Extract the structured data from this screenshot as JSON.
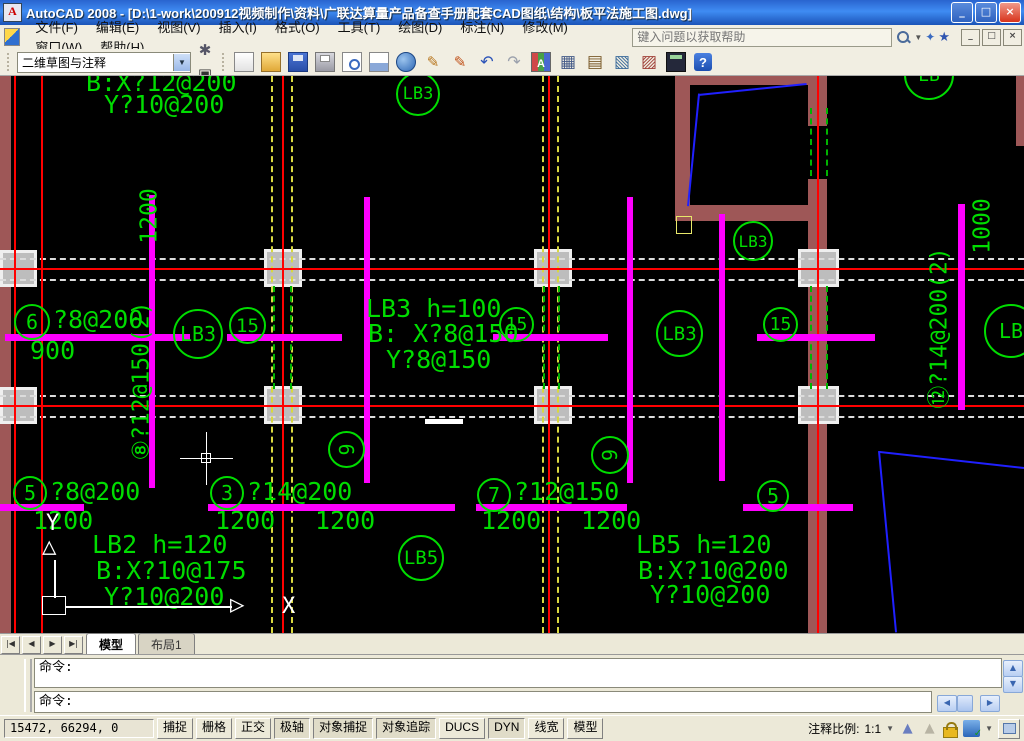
{
  "title_bar": {
    "title": "AutoCAD 2008 - [D:\\1-work\\200912视频制作\\资料\\广联达算量产品备查手册配套CAD图纸\\结构\\板平法施工图.dwg]",
    "buttons": {
      "minimize": "_",
      "restore": "□",
      "close": "×"
    }
  },
  "menu": {
    "items": [
      "文件(F)",
      "编辑(E)",
      "视图(V)",
      "插入(I)",
      "格式(O)",
      "工具(T)",
      "绘图(D)",
      "标注(N)",
      "修改(M)",
      "窗口(W)",
      "帮助(H)"
    ],
    "search_placeholder": "键入问题以获取帮助",
    "mdi_buttons": {
      "minimize": "_",
      "restore": "□",
      "close": "×"
    }
  },
  "toolbar": {
    "workspace": "二维草图与注释",
    "workspace_buttons": [
      "gear",
      "ws"
    ],
    "icons": [
      "new",
      "open",
      "save",
      "plot",
      "preview",
      "publish",
      "web",
      "pencil",
      "pencil2",
      "undo",
      "redo",
      "matchprop",
      "layers",
      "sheetset",
      "markup",
      "blockedit",
      "calc",
      "help"
    ]
  },
  "tabs": {
    "nav": [
      "|◀",
      "◀",
      "▶",
      "▶|"
    ],
    "items": [
      {
        "label": "模型",
        "active": true
      },
      {
        "label": "布局1",
        "active": false
      }
    ]
  },
  "command": {
    "history": "命令:",
    "prompt": "命令:"
  },
  "status": {
    "coords": "15472, 66294, 0",
    "toggles": [
      {
        "label": "捕捉",
        "on": false
      },
      {
        "label": "栅格",
        "on": false
      },
      {
        "label": "正交",
        "on": false
      },
      {
        "label": "极轴",
        "on": true
      },
      {
        "label": "对象捕捉",
        "on": true
      },
      {
        "label": "对象追踪",
        "on": true
      },
      {
        "label": "DUCS",
        "on": false
      },
      {
        "label": "DYN",
        "on": true
      },
      {
        "label": "线宽",
        "on": false
      },
      {
        "label": "模型",
        "on": false
      }
    ],
    "scale_label": "注释比例:",
    "scale_value": "1:1"
  },
  "drawing": {
    "colors": {
      "text_green": "#00dd00",
      "rebar_magenta": "#ff00ff",
      "grid_red": "#ff0000",
      "axis_yellow": "#d8d840",
      "wall_brown": "#9e5757",
      "stair_blue": "#2020ff"
    },
    "entities": [
      {
        "t": "wall",
        "x": 0,
        "y": 0,
        "w": 11,
        "h": 557
      },
      {
        "t": "wall",
        "x": 675,
        "y": 0,
        "w": 152,
        "h": 9
      },
      {
        "t": "wall",
        "x": 675,
        "y": 0,
        "w": 15,
        "h": 145
      },
      {
        "t": "wall",
        "x": 675,
        "y": 129,
        "w": 152,
        "h": 16
      },
      {
        "t": "wall",
        "x": 808,
        "y": 0,
        "w": 19,
        "h": 50
      },
      {
        "t": "wall",
        "x": 808,
        "y": 103,
        "w": 19,
        "h": 454
      },
      {
        "t": "wall",
        "x": 1016,
        "y": 0,
        "w": 8,
        "h": 70
      },
      {
        "t": "col",
        "x": 0,
        "y": 174,
        "w": 37,
        "h": 37
      },
      {
        "t": "col",
        "x": 264,
        "y": 173,
        "w": 38,
        "h": 38
      },
      {
        "t": "col",
        "x": 534,
        "y": 173,
        "w": 38,
        "h": 38
      },
      {
        "t": "col",
        "x": 798,
        "y": 173,
        "w": 41,
        "h": 38
      },
      {
        "t": "col",
        "x": 0,
        "y": 311,
        "w": 37,
        "h": 37
      },
      {
        "t": "col",
        "x": 264,
        "y": 310,
        "w": 38,
        "h": 38
      },
      {
        "t": "col",
        "x": 534,
        "y": 310,
        "w": 38,
        "h": 38
      },
      {
        "t": "col",
        "x": 798,
        "y": 310,
        "w": 41,
        "h": 38
      },
      {
        "t": "hline",
        "y": 182,
        "x1": 0,
        "x2": 1024,
        "c": "#dcdcdc",
        "h": 2,
        "dash": true
      },
      {
        "t": "hline",
        "y": 203,
        "x1": 0,
        "x2": 1024,
        "c": "#dcdcdc",
        "h": 2,
        "dash": true
      },
      {
        "t": "hline",
        "y": 319,
        "x1": 0,
        "x2": 1024,
        "c": "#dcdcdc",
        "h": 2,
        "dash": true
      },
      {
        "t": "hline",
        "y": 340,
        "x1": 0,
        "x2": 1024,
        "c": "#dcdcdc",
        "h": 2,
        "dash": true
      },
      {
        "t": "vline",
        "x": 271,
        "y1": 0,
        "y2": 557,
        "c": "#d8d840",
        "w": 2,
        "dash": true
      },
      {
        "t": "vline",
        "x": 291,
        "y1": 0,
        "y2": 557,
        "c": "#d8d840",
        "w": 2,
        "dash": true
      },
      {
        "t": "vline",
        "x": 542,
        "y1": 0,
        "y2": 557,
        "c": "#d8d840",
        "w": 2,
        "dash": true
      },
      {
        "t": "vline",
        "x": 557,
        "y1": 0,
        "y2": 557,
        "c": "#d8d840",
        "w": 2,
        "dash": true
      },
      {
        "t": "hline",
        "y": 192,
        "x1": 0,
        "x2": 1024,
        "c": "#ff0000",
        "h": 2
      },
      {
        "t": "hline",
        "y": 329,
        "x1": 0,
        "x2": 1024,
        "c": "#ff0000",
        "h": 2
      },
      {
        "t": "vline",
        "x": 14,
        "y1": 0,
        "y2": 557,
        "c": "#ff0000",
        "w": 2
      },
      {
        "t": "vline",
        "x": 41,
        "y1": 0,
        "y2": 557,
        "c": "#ff0000",
        "w": 2
      },
      {
        "t": "vline",
        "x": 282,
        "y1": 0,
        "y2": 557,
        "c": "#ff0000",
        "w": 2
      },
      {
        "t": "vline",
        "x": 548,
        "y1": 0,
        "y2": 557,
        "c": "#ff0000",
        "w": 2
      },
      {
        "t": "vline",
        "x": 817,
        "y1": 0,
        "y2": 557,
        "c": "#ff0000",
        "w": 2
      },
      {
        "t": "vline",
        "x": 273,
        "y1": 210,
        "y2": 313,
        "c": "#00b400",
        "w": 2,
        "dash": true
      },
      {
        "t": "vline",
        "x": 290,
        "y1": 210,
        "y2": 313,
        "c": "#00b400",
        "w": 2,
        "dash": true
      },
      {
        "t": "vline",
        "x": 543,
        "y1": 210,
        "y2": 313,
        "c": "#00b400",
        "w": 2,
        "dash": true
      },
      {
        "t": "vline",
        "x": 558,
        "y1": 210,
        "y2": 313,
        "c": "#00b400",
        "w": 2,
        "dash": true
      },
      {
        "t": "vline",
        "x": 810,
        "y1": 210,
        "y2": 313,
        "c": "#00b400",
        "w": 2,
        "dash": true
      },
      {
        "t": "vline",
        "x": 826,
        "y1": 210,
        "y2": 313,
        "c": "#00b400",
        "w": 2,
        "dash": true
      },
      {
        "t": "vline",
        "x": 810,
        "y1": 32,
        "y2": 100,
        "c": "#00b400",
        "w": 2,
        "dash": true
      },
      {
        "t": "vline",
        "x": 826,
        "y1": 32,
        "y2": 100,
        "c": "#00b400",
        "w": 2,
        "dash": true
      },
      {
        "t": "rect",
        "x": 149,
        "y": 119,
        "w": 6,
        "h": 293,
        "c": "#ff00ff"
      },
      {
        "t": "rect",
        "x": 364,
        "y": 121,
        "w": 6,
        "h": 286,
        "c": "#ff00ff"
      },
      {
        "t": "rect",
        "x": 627,
        "y": 121,
        "w": 6,
        "h": 286,
        "c": "#ff00ff"
      },
      {
        "t": "rect",
        "x": 719,
        "y": 138,
        "w": 6,
        "h": 267,
        "c": "#ff00ff"
      },
      {
        "t": "rect",
        "x": 958,
        "y": 128,
        "w": 7,
        "h": 206,
        "c": "#ff00ff"
      },
      {
        "t": "rect",
        "x": 5,
        "y": 258,
        "w": 185,
        "h": 7,
        "c": "#ff00ff"
      },
      {
        "t": "rect",
        "x": 227,
        "y": 258,
        "w": 115,
        "h": 7,
        "c": "#ff00ff"
      },
      {
        "t": "rect",
        "x": 493,
        "y": 258,
        "w": 115,
        "h": 7,
        "c": "#ff00ff"
      },
      {
        "t": "rect",
        "x": 757,
        "y": 258,
        "w": 118,
        "h": 7,
        "c": "#ff00ff"
      },
      {
        "t": "rect",
        "x": 0,
        "y": 428,
        "w": 84,
        "h": 7,
        "c": "#ff00ff"
      },
      {
        "t": "rect",
        "x": 208,
        "y": 428,
        "w": 247,
        "h": 7,
        "c": "#ff00ff"
      },
      {
        "t": "rect",
        "x": 476,
        "y": 428,
        "w": 151,
        "h": 7,
        "c": "#ff00ff"
      },
      {
        "t": "rect",
        "x": 743,
        "y": 428,
        "w": 110,
        "h": 7,
        "c": "#ff00ff"
      },
      {
        "t": "rect",
        "x": 425,
        "y": 343,
        "w": 38,
        "h": 5,
        "c": "#ffffff"
      },
      {
        "t": "orect",
        "x": 676,
        "y": 140,
        "w": 16,
        "h": 18,
        "c": "#e8e86a"
      },
      {
        "t": "sline",
        "x1": 687,
        "y1": 130,
        "x2": 698,
        "y2": 18,
        "c": "#2020ff"
      },
      {
        "t": "sline",
        "x1": 698,
        "y1": 18,
        "x2": 806,
        "y2": 7,
        "c": "#2020ff"
      },
      {
        "t": "sline",
        "x1": 880,
        "y1": 375,
        "x2": 1024,
        "y2": 391,
        "c": "#2020ff"
      },
      {
        "t": "sline",
        "x1": 880,
        "y1": 375,
        "x2": 897,
        "y2": 556,
        "c": "#2020ff"
      },
      {
        "t": "text",
        "x": 86,
        "y": -6,
        "s": "B:X?12@200"
      },
      {
        "t": "text",
        "x": 104,
        "y": 16,
        "s": "Y?10@200"
      },
      {
        "t": "text",
        "x": 366,
        "y": 220,
        "s": "LB3 h=100"
      },
      {
        "t": "text",
        "x": 368,
        "y": 245,
        "s": "B: X?8@150"
      },
      {
        "t": "text",
        "x": 386,
        "y": 271,
        "s": "Y?8@150"
      },
      {
        "t": "gcirc",
        "x": 14,
        "y": 228,
        "d": 36,
        "s": "6"
      },
      {
        "t": "text",
        "x": 53,
        "y": 231,
        "s": "?8@200"
      },
      {
        "t": "text",
        "x": 30,
        "y": 262,
        "s": "900"
      },
      {
        "t": "gcirc",
        "x": 13,
        "y": 400,
        "d": 34,
        "s": "5"
      },
      {
        "t": "text",
        "x": 50,
        "y": 403,
        "s": "?8@200"
      },
      {
        "t": "text",
        "x": 33,
        "y": 432,
        "s": "1200"
      },
      {
        "t": "gcirc",
        "x": 210,
        "y": 400,
        "d": 34,
        "s": "3"
      },
      {
        "t": "text",
        "x": 247,
        "y": 403,
        "s": "?14@200"
      },
      {
        "t": "text",
        "x": 215,
        "y": 432,
        "s": "1200"
      },
      {
        "t": "text",
        "x": 315,
        "y": 432,
        "s": "1200"
      },
      {
        "t": "text",
        "x": 92,
        "y": 456,
        "s": "LB2 h=120"
      },
      {
        "t": "text",
        "x": 96,
        "y": 482,
        "s": "B:X?10@175"
      },
      {
        "t": "text",
        "x": 104,
        "y": 508,
        "s": "Y?10@200"
      },
      {
        "t": "gcirc",
        "x": 477,
        "y": 402,
        "d": 34,
        "s": "7"
      },
      {
        "t": "text",
        "x": 514,
        "y": 403,
        "s": "?12@150"
      },
      {
        "t": "text",
        "x": 481,
        "y": 432,
        "s": "1200"
      },
      {
        "t": "text",
        "x": 581,
        "y": 432,
        "s": "1200"
      },
      {
        "t": "gcirc",
        "x": 757,
        "y": 404,
        "d": 32,
        "s": "5"
      },
      {
        "t": "text",
        "x": 636,
        "y": 456,
        "s": "LB5 h=120"
      },
      {
        "t": "text",
        "x": 638,
        "y": 482,
        "s": "B:X?10@200"
      },
      {
        "t": "text",
        "x": 650,
        "y": 506,
        "s": "Y?10@200"
      },
      {
        "t": "gcirc",
        "x": 398,
        "y": 459,
        "d": 46,
        "s": "LB5",
        "fs": 19
      },
      {
        "t": "gcirc",
        "x": 173,
        "y": 233,
        "d": 50,
        "s": "LB3",
        "fs": 20
      },
      {
        "t": "gcirc",
        "x": 229,
        "y": 231,
        "d": 37,
        "s": "15",
        "fs": 19
      },
      {
        "t": "gcirc",
        "x": 499,
        "y": 231,
        "d": 35,
        "s": "15",
        "fs": 18
      },
      {
        "t": "gcirc",
        "x": 763,
        "y": 231,
        "d": 35,
        "s": "15",
        "fs": 18
      },
      {
        "t": "gcirc",
        "x": 656,
        "y": 234,
        "d": 47,
        "s": "LB3",
        "fs": 19
      },
      {
        "t": "gcirc",
        "x": 733,
        "y": 145,
        "d": 40,
        "s": "LB3",
        "fs": 16
      },
      {
        "t": "gcirc",
        "x": 396,
        "y": -4,
        "d": 44,
        "s": "LB3",
        "fs": 17
      },
      {
        "t": "gcirc",
        "x": 904,
        "y": -26,
        "d": 50,
        "s": "LB",
        "fs": 18
      },
      {
        "t": "gcirc",
        "x": 984,
        "y": 228,
        "d": 54,
        "s": "LB",
        "fs": 20
      },
      {
        "t": "gcirc",
        "x": 328,
        "y": 355,
        "d": 37,
        "s": "9",
        "rot": -90
      },
      {
        "t": "gcirc",
        "x": 591,
        "y": 360,
        "d": 38,
        "s": "9",
        "rot": -90
      },
      {
        "t": "vtext",
        "cx": 142,
        "cy": 305,
        "s": "⑧?12@150(2)"
      },
      {
        "t": "vtext",
        "cx": 150,
        "cy": 140,
        "s": "1200"
      },
      {
        "t": "vtext",
        "cx": 940,
        "cy": 252,
        "s": "⑫?14@200(2)"
      },
      {
        "t": "vtext",
        "cx": 983,
        "cy": 150,
        "s": "1000"
      },
      {
        "t": "text",
        "x": 46,
        "y": 436,
        "s": "Y",
        "c": "#ffffff",
        "fs": 22
      },
      {
        "t": "text",
        "x": 42,
        "y": 458,
        "s": "△",
        "c": "#ffffff",
        "fs": 24
      },
      {
        "t": "vline",
        "x": 54,
        "y1": 484,
        "y2": 522,
        "c": "#ffffff",
        "w": 2
      },
      {
        "t": "orect",
        "x": 42,
        "y": 520,
        "w": 24,
        "h": 19,
        "c": "#ffffff"
      },
      {
        "t": "hline",
        "y": 530,
        "x1": 66,
        "x2": 232,
        "c": "#ffffff",
        "h": 2
      },
      {
        "t": "text",
        "x": 230,
        "y": 516,
        "s": "▷",
        "c": "#ffffff",
        "fs": 24
      },
      {
        "t": "text",
        "x": 282,
        "y": 519,
        "s": "X",
        "c": "#ffffff",
        "fs": 22
      },
      {
        "t": "hline",
        "y": 382,
        "x1": 180,
        "x2": 233,
        "c": "#ffffff",
        "h": 1
      },
      {
        "t": "vline",
        "x": 206,
        "y1": 356,
        "y2": 409,
        "c": "#ffffff",
        "w": 1
      },
      {
        "t": "orect",
        "x": 201,
        "y": 377,
        "w": 10,
        "h": 10,
        "c": "#ffffff"
      }
    ]
  }
}
